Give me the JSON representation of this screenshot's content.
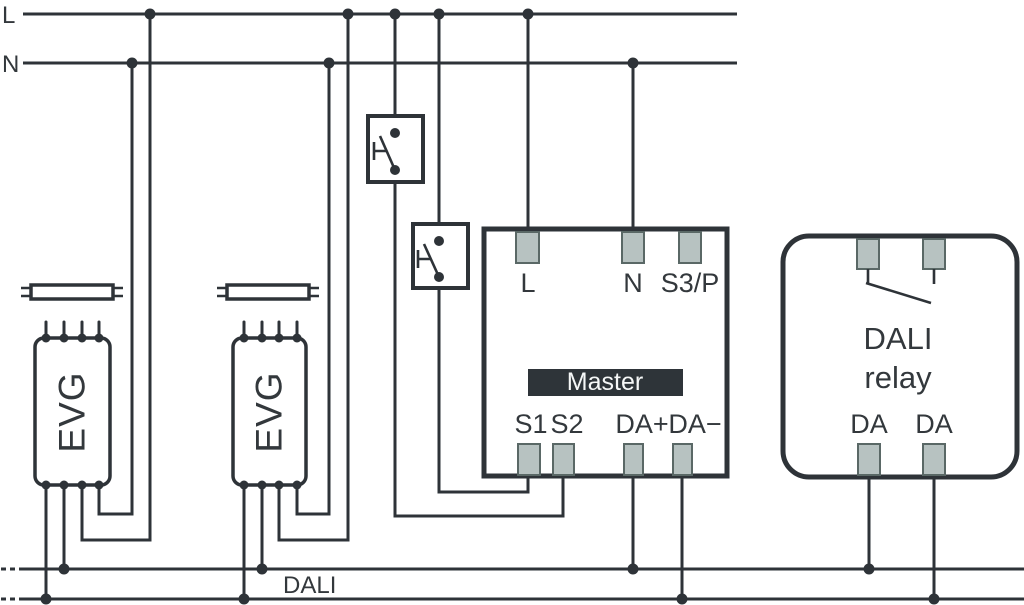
{
  "colors": {
    "background": "#ffffff",
    "wire": "#2e3338",
    "text": "#33383c",
    "terminal_fill": "#b7c2c1",
    "terminal_border": "#5a6866",
    "badge_bg": "#2e3439",
    "badge_text": "#f5f7f7"
  },
  "rails": {
    "l": "L",
    "n": "N"
  },
  "ballasts": {
    "label_1": "EVG",
    "label_2": "EVG"
  },
  "master": {
    "badge": "Master",
    "terminal_l": "L",
    "terminal_n": "N",
    "terminal_s3p": "S3/P",
    "terminal_s1": "S1",
    "terminal_s2": "S2",
    "terminal_da_plus": "DA+",
    "terminal_da_minus": "DA−"
  },
  "relay": {
    "name_line1": "DALI",
    "name_line2": "relay",
    "terminal_da_1": "DA",
    "terminal_da_2": "DA"
  },
  "bus": {
    "label": "DALI"
  }
}
